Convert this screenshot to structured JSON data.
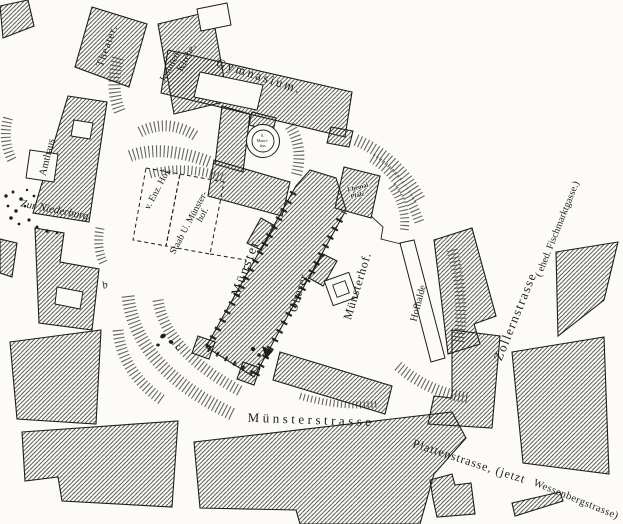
{
  "map_type": "historical-town-plan-engraving",
  "colors": {
    "paper": "#fcfbf8",
    "ink": "#1d1d1b",
    "hatch": "#2e2e2c",
    "hachure": "#4a4a46"
  },
  "labels": {
    "theater": "Theater.",
    "jesuiten_line1": "Jesuiten-",
    "jesuiten_line2": "Kirche.",
    "gymnasium": "Gymnasium.",
    "mauritius_line1": "S.",
    "mauritius_line2": "Mauri-",
    "mauritius_line3": "tius",
    "amthaus": "Amthaus",
    "zur_niederburg": "Zur Niederburg",
    "enz_hof": "v. Enz. Hof.",
    "staab_line1": "Staab U. Münster-",
    "staab_line2": "hof.",
    "muenster": "Münster.",
    "oberer": "Oberer",
    "muensterhof": "Münsterhof.",
    "pfalz_line1": "Ehemal.",
    "pfalz_line2": "Pfalz",
    "hofhalde": "Hofhalde",
    "muensterstrasse": "Münsterstrasse",
    "plattenstrasse_part1": "Plattenstrasse, (jetzt",
    "plattenstrasse_part2": "Wessenbergstrasse)",
    "zollernstrasse": "Zollernstrasse",
    "zollernstrasse_paren": "( ehed. Fischmarktgasse.)",
    "marker_b": "b",
    "marker_c": "c"
  }
}
